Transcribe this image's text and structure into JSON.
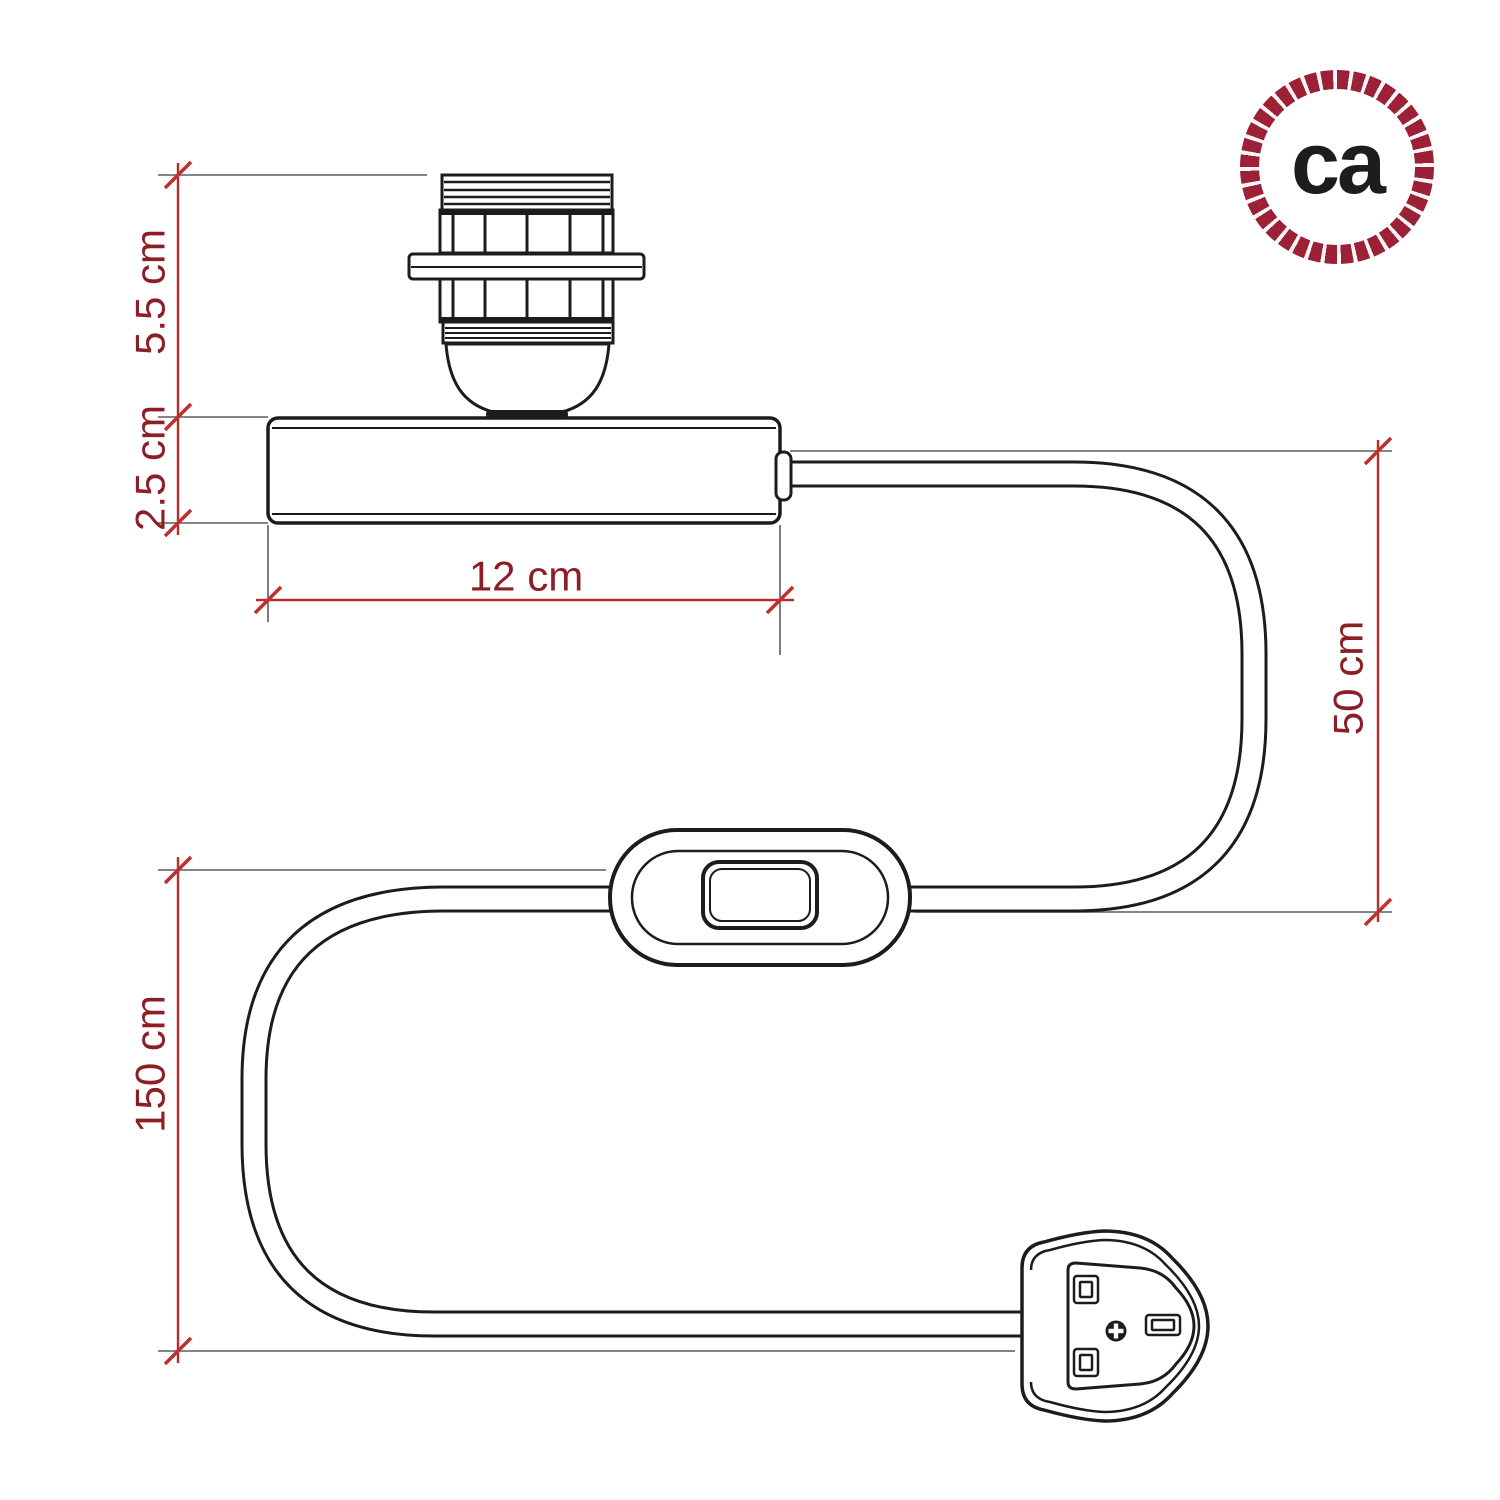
{
  "logo": {
    "text": "ca"
  },
  "dimensions": {
    "socket_height": "5.5 cm",
    "base_height": "2.5 cm",
    "base_width": "12 cm",
    "holder_to_switch": "50 cm",
    "total_cable": "150 cm"
  },
  "colors": {
    "dimension_line": "#b82e2e",
    "dimension_text": "#8c1f26",
    "drawing_outline": "#1c1c1c",
    "extension_line": "#5b5b5b",
    "logo_rope": "#9c2136",
    "logo_text": "#1d1d20",
    "background": "#ffffff"
  }
}
